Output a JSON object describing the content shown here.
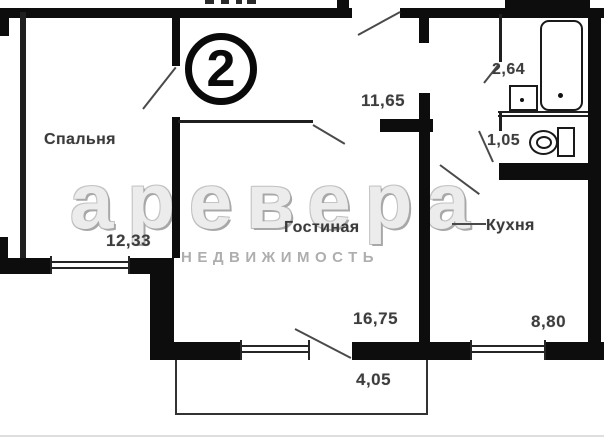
{
  "watermark": {
    "brand": "аревера",
    "subtitle": "НЕДВИЖИМОСТЬ"
  },
  "badge": {
    "apartment_number": "2"
  },
  "rooms": {
    "bedroom": {
      "name": "Спальня",
      "area": "12,33"
    },
    "living": {
      "name": "Гостиная",
      "area": "16,75"
    },
    "kitchen": {
      "name": "Кухня",
      "area": "8,80"
    },
    "hall": {
      "area": "11,65"
    },
    "bathroom": {
      "area": "2,64"
    },
    "wc": {
      "area": "1,05"
    },
    "balcony": {
      "area": "4,05"
    }
  }
}
